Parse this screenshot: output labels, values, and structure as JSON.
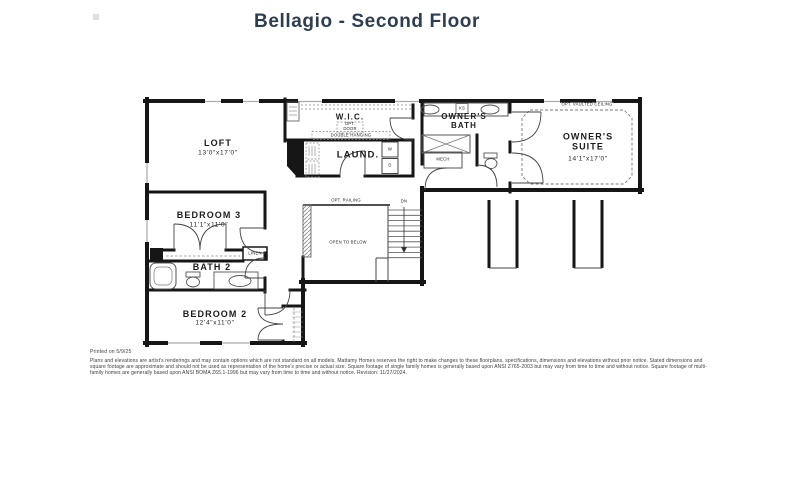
{
  "title": "Bellagio - Second Floor",
  "colors": {
    "title_text": "#2e3e52",
    "wall": "#161616",
    "fixture_line": "#555555",
    "dashed_line": "#888888",
    "background": "#ffffff"
  },
  "rooms": {
    "loft": {
      "name": "LOFT",
      "dims": "13'0\"x17'0\""
    },
    "wic": {
      "name": "W.I.C."
    },
    "laundry": {
      "name": "LAUND."
    },
    "owners_bath": {
      "name": "OWNER'S\nBATH"
    },
    "owners_suite": {
      "name": "OWNER'S\nSUITE",
      "dims": "14'1\"x17'0\""
    },
    "bedroom3": {
      "name": "BEDROOM 3",
      "dims": "11'1\"x11'0\""
    },
    "bath2": {
      "name": "BATH 2"
    },
    "bedroom2": {
      "name": "BEDROOM 2",
      "dims": "12'4\"x11'0\""
    }
  },
  "annotations": {
    "opt_door": "OPT.\nDOOR",
    "double_hanging": "DOUBLE HANGING",
    "opt_vaulted_ceiling": "OPT. VAULTED CEILING",
    "opt_railing": "OPT. RAILING",
    "open_to_below": "OPEN TO BELOW",
    "down": "DN",
    "linen": "LINEN",
    "mech": "MECH",
    "knee_space": "KS",
    "washer": "W",
    "dryer": "D"
  },
  "footer": {
    "printed_on": "Printed on 5/9/25",
    "disclaimer": "Plans and elevations are artist's renderings and may contain options which are not standard on all models. Mattamy Homes reserves the right to make changes to these floorplans, specifications, dimensions and elevations without prior notice. Stated dimensions and square footage are approximate and should not be used as representation of the home's precise or actual size. Square footage of single family homes is generally based upon ANSI Z765-2003 but may vary from time to time and without notice. Square footage of multi-family homes are generally based upon ANSI BOMA Z65.1-1996 but may vary from time to time and without notice. Revision: 11/27/2024."
  }
}
